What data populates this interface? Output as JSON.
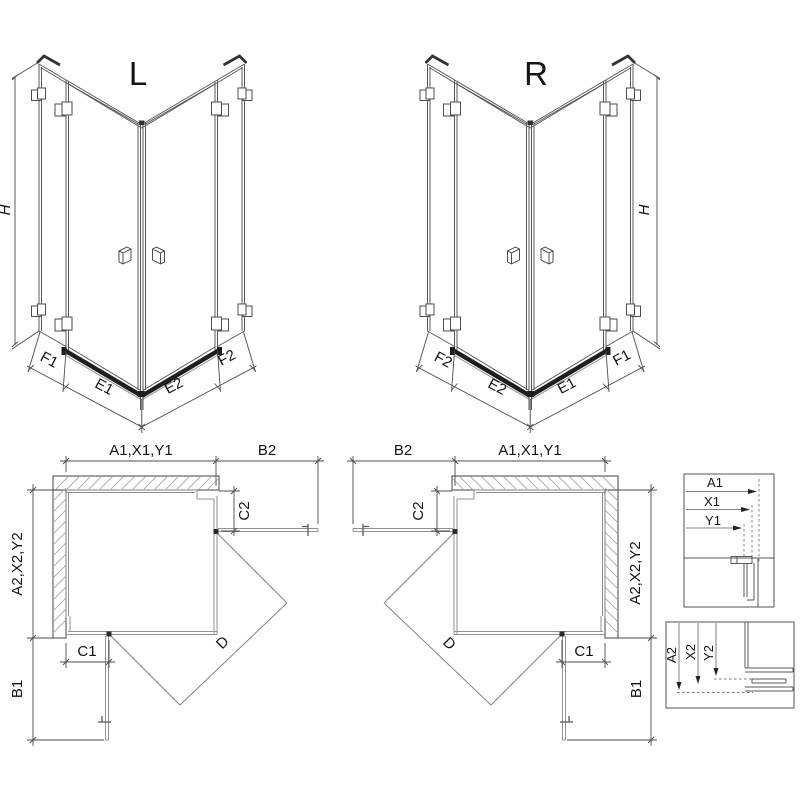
{
  "drawing": {
    "perspective_left": {
      "title": "L",
      "height": "H",
      "bottom": [
        "F1",
        "E1",
        "E2",
        "F2"
      ]
    },
    "perspective_right": {
      "title": "R",
      "height": "H",
      "bottom": [
        "F2",
        "E2",
        "E1",
        "F1"
      ]
    },
    "plan_left": {
      "top_width": "A1,X1,Y1",
      "open_door_top": "B2",
      "depth": "A2,X2,Y2",
      "fixed_side": "C2",
      "fixed_bottom": "C1",
      "open_door_bottom": "B1",
      "diagonal": "D"
    },
    "plan_right": {
      "top_width": "A1,X1,Y1",
      "open_door_top": "B2",
      "depth": "A2,X2,Y2",
      "fixed_side": "C2",
      "fixed_bottom": "C1",
      "open_door_bottom": "B1",
      "diagonal": "D"
    },
    "detail_width": {
      "dims": [
        "A1",
        "X1",
        "Y1"
      ]
    },
    "detail_depth": {
      "dims": [
        "A2",
        "X2",
        "Y2"
      ]
    }
  },
  "colors": {
    "background": "#ffffff",
    "line": "#55585c",
    "dark": "#1e1e1e",
    "glass": "#8d9296",
    "dimension": "#4c4c4c",
    "hatch": "#a9aeb4",
    "text": "#141414"
  }
}
